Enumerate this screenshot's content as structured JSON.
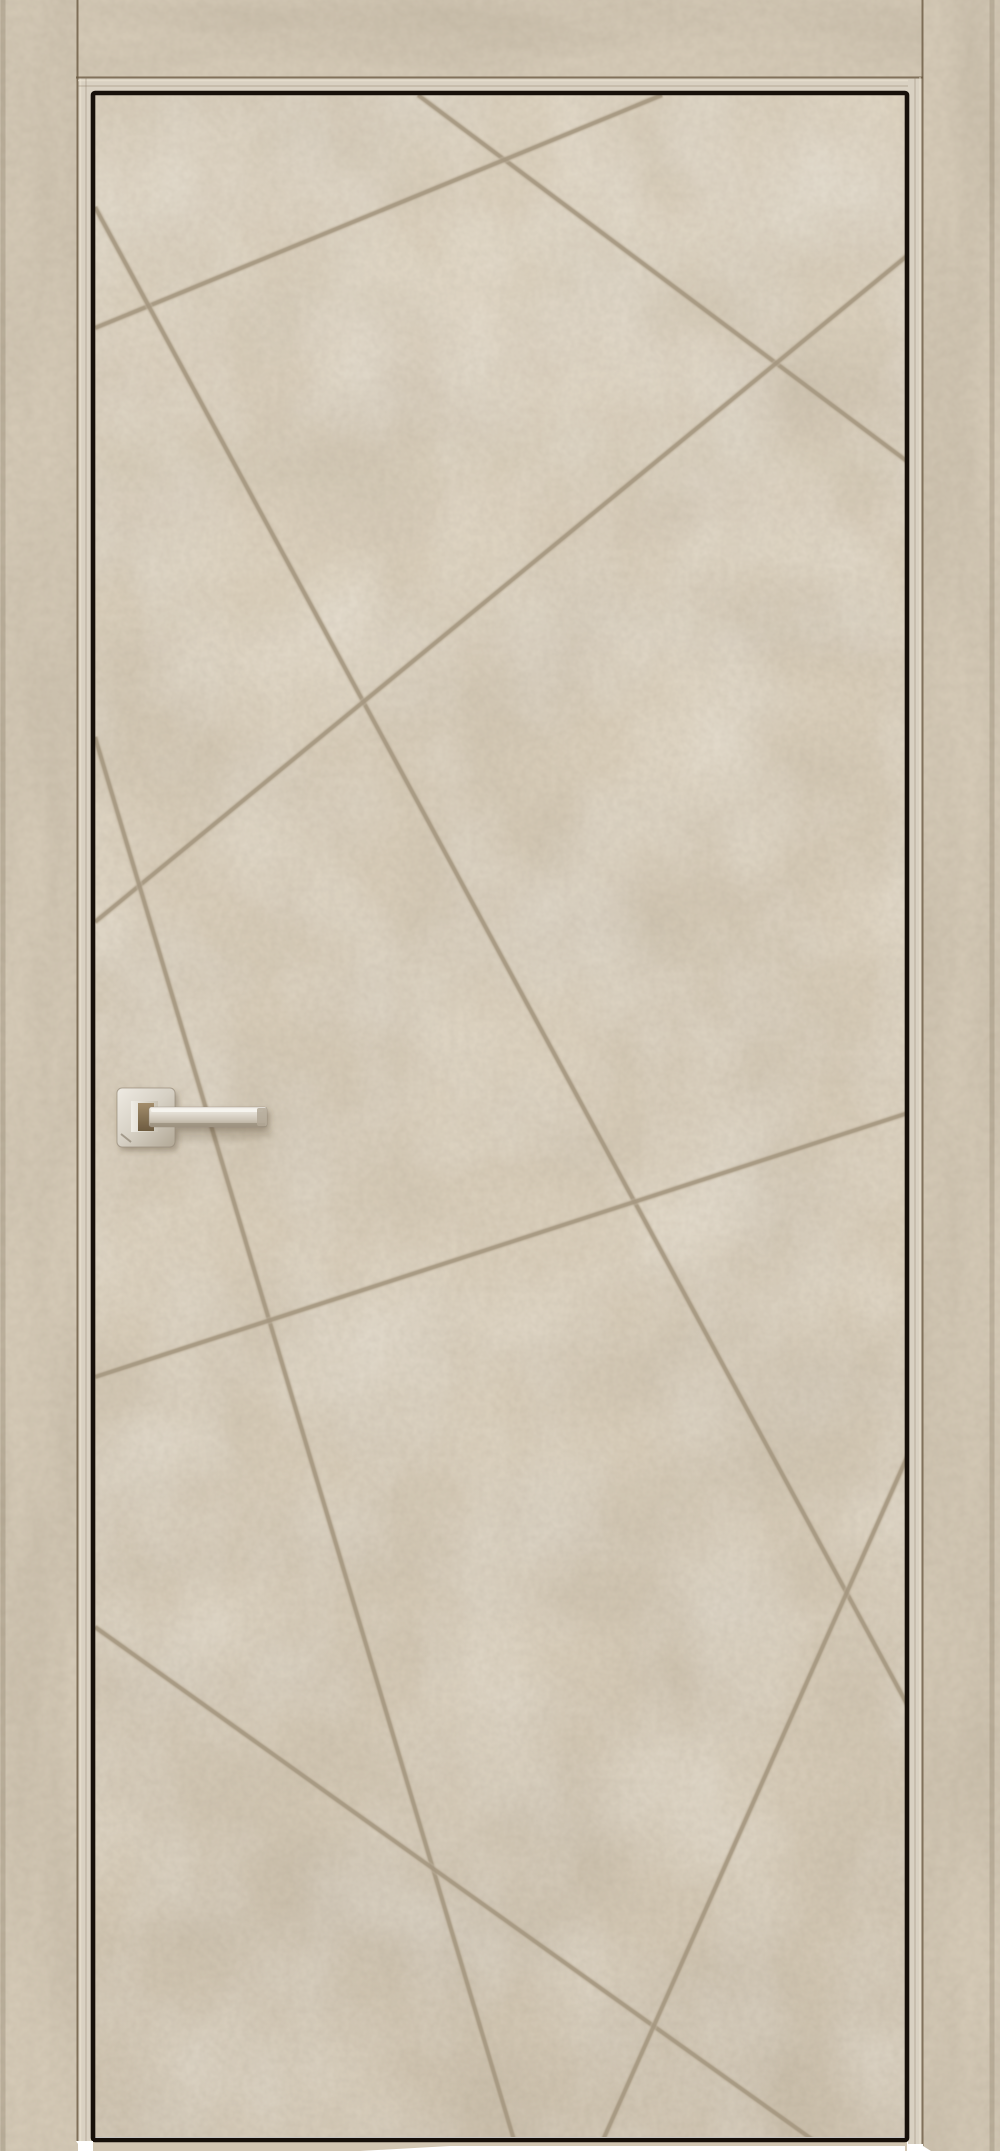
{
  "scene": {
    "type": "product-photo",
    "subject": "interior door leaf with geometric engraved groove pattern, beige concrete finish, square-rosette lever handle pointing right, matching door casing",
    "canvas": {
      "width": 1000,
      "height": 2151
    }
  },
  "palette": {
    "background": "#ffffff",
    "casing": "#d4c9b6",
    "jamb": "#d9d1c2",
    "panel": "#d9ceba",
    "threshold": "#d2c6b2",
    "groove": "#a59780",
    "groove_soft": "#c3b7a2",
    "gap": "#17100a",
    "edge_dark": "#6a5941",
    "edge_light": "#ece5d6",
    "metal_light": "#f3f0e9",
    "metal_mid": "#d7d1c5",
    "metal_dark": "#a89d8a",
    "bronze_dark": "#8a765a",
    "shadow": "#54462f"
  },
  "frame": {
    "left_casing": {
      "x": 0,
      "y": 0,
      "width": 78,
      "height": 2151
    },
    "head_casing": {
      "x": 78,
      "y": 0,
      "width": 845,
      "height": 77
    },
    "right_casing": {
      "x": 923,
      "y": 0,
      "width": 77,
      "height": 2151
    },
    "left_jamb": {
      "x": 78,
      "y": 77,
      "width": 15,
      "height": 2064
    },
    "top_jamb": {
      "x": 78,
      "y": 77,
      "width": 830,
      "height": 16
    },
    "right_jamb": {
      "x": 908,
      "y": 77,
      "width": 15,
      "height": 2067
    },
    "threshold": {
      "x": 93,
      "y": 2140,
      "width": 814,
      "height": 11
    }
  },
  "door": {
    "leaf": {
      "x": 95,
      "y": 95,
      "width": 810,
      "height": 2042
    },
    "gap_outline": {
      "x": 93,
      "y": 93,
      "width": 814,
      "height": 2047
    },
    "groove_width": 4.2,
    "pattern_grooves": [
      {
        "x1": 418,
        "y1": 95,
        "x2": 908,
        "y2": 462
      },
      {
        "x1": 662,
        "y1": 95,
        "x2": 95,
        "y2": 328
      },
      {
        "x1": 95,
        "y1": 207,
        "x2": 908,
        "y2": 1706
      },
      {
        "x1": 908,
        "y1": 255,
        "x2": 95,
        "y2": 922
      },
      {
        "x1": 95,
        "y1": 737,
        "x2": 514,
        "y2": 2140
      },
      {
        "x1": 908,
        "y1": 1113,
        "x2": 95,
        "y2": 1377
      },
      {
        "x1": 95,
        "y1": 1627,
        "x2": 813,
        "y2": 2140
      },
      {
        "x1": 908,
        "y1": 1455,
        "x2": 603,
        "y2": 2140
      }
    ]
  },
  "handle": {
    "orientation": "lever-pointing-right",
    "rosette": {
      "x": 117,
      "y": 1088,
      "width": 58,
      "height": 59,
      "radius": 5
    },
    "neck": {
      "x": 131,
      "y": 1101,
      "width": 27,
      "height": 31
    },
    "neck_inner": {
      "x": 138,
      "y": 1103,
      "width": 16,
      "height": 28
    },
    "lever": {
      "x": 149,
      "y": 1107,
      "width": 118,
      "height": 20,
      "radius": 2.5
    }
  }
}
